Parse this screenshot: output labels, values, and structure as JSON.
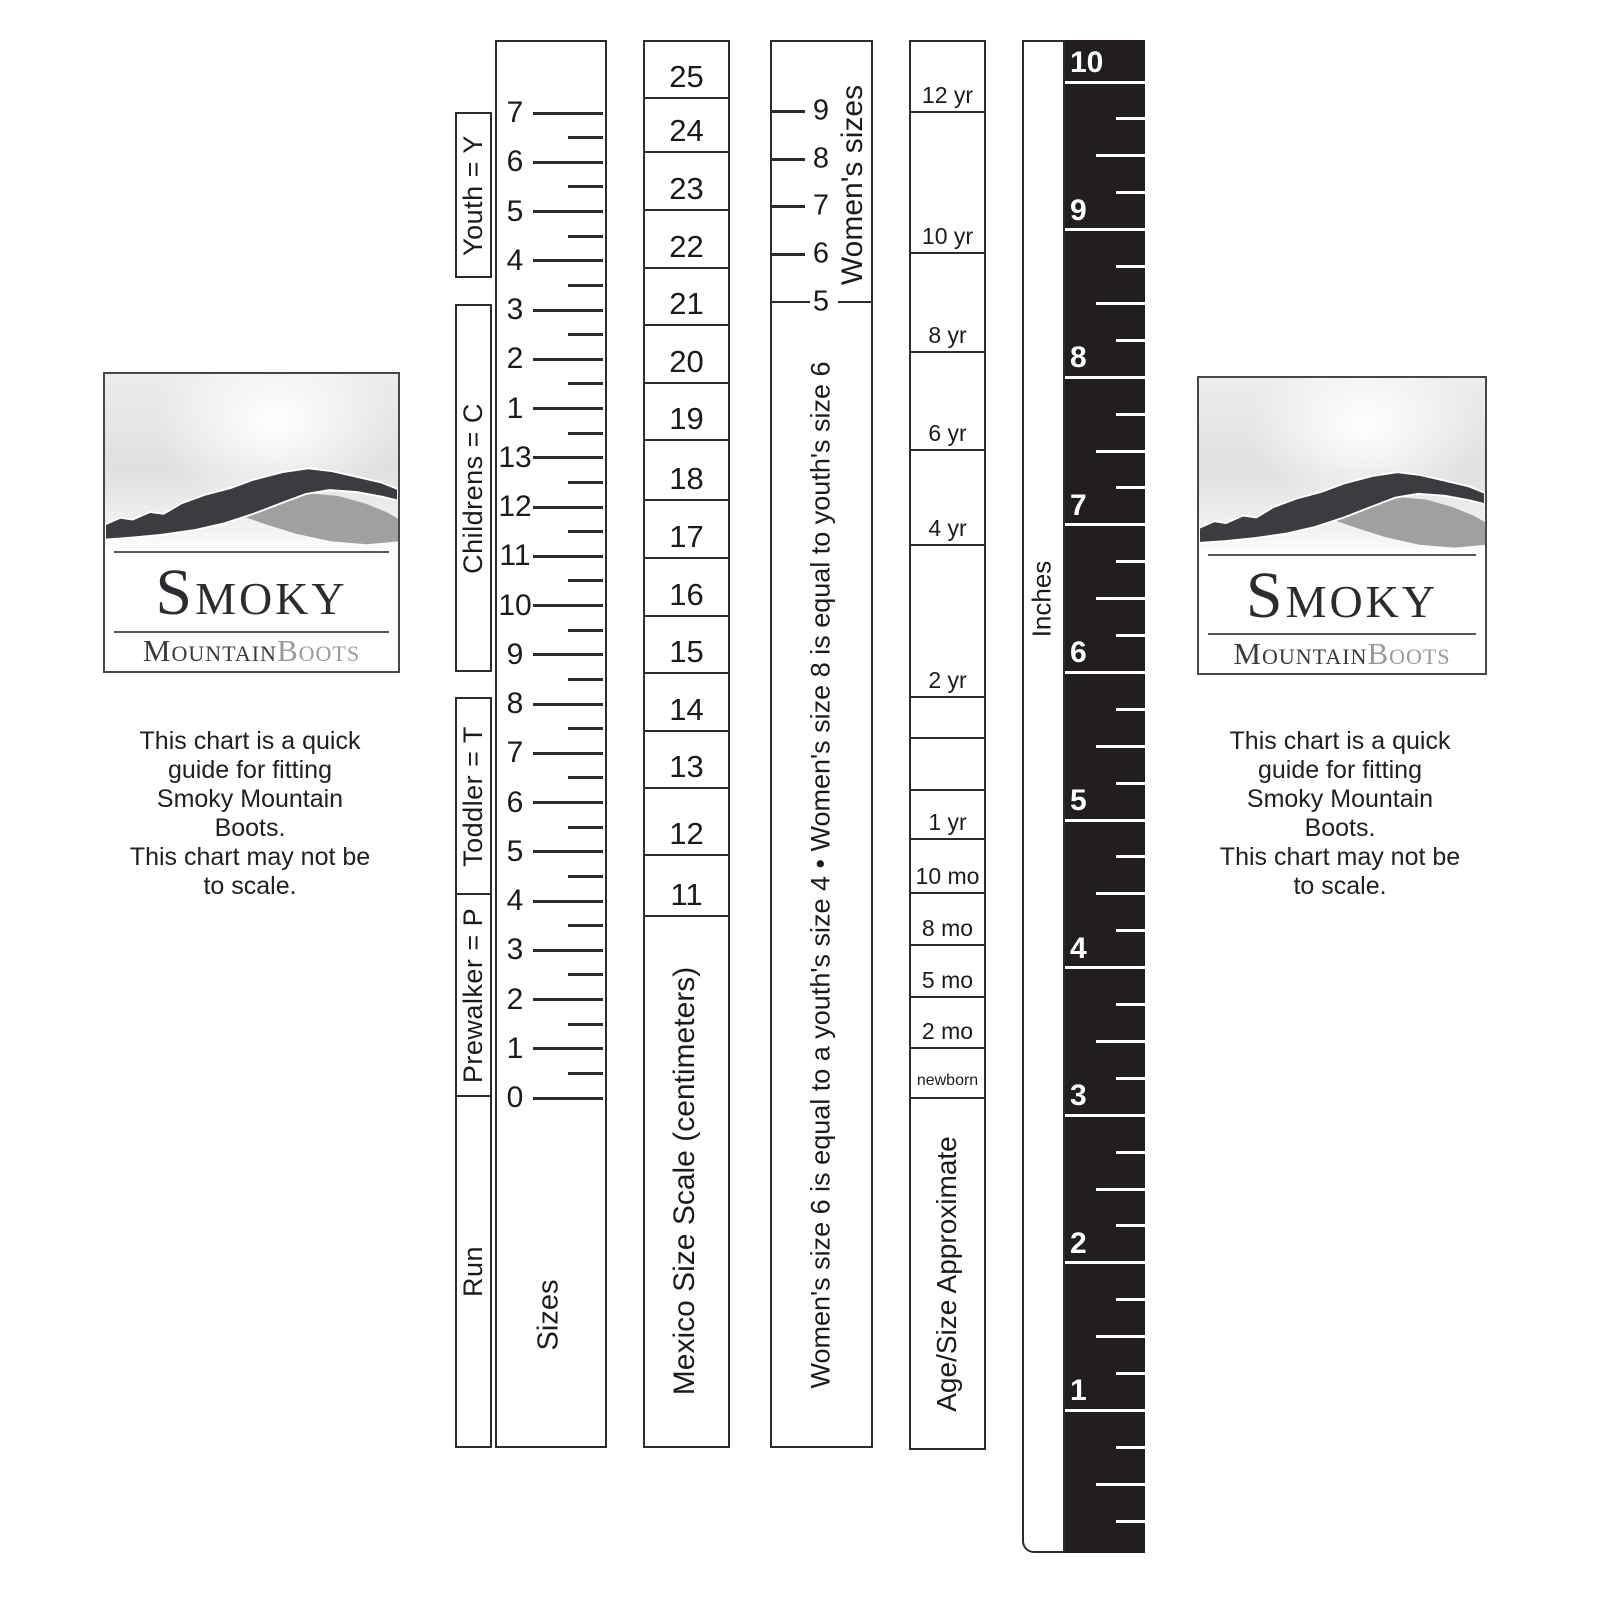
{
  "colors": {
    "line": "#2b2b2b",
    "ink": "#1b1b1b",
    "ruler_black": "#221e1e",
    "logo_dark": "#3c3c40",
    "logo_gray": "#a0a0a3",
    "boots_text": "#9a9a9a"
  },
  "logo": {
    "title": "Smoky",
    "word_dark": "Mountain",
    "word_light": "Boots"
  },
  "note": {
    "lines": [
      "This chart is a quick",
      "guide for fitting",
      "Smoky Mountain",
      "Boots.",
      "This chart may not be",
      "to scale."
    ]
  },
  "bracket_column": {
    "boxes": [
      {
        "label": "Youth = Y",
        "top": 112,
        "bottom": 278
      },
      {
        "label": "Childrens = C",
        "top": 304,
        "bottom": 672
      },
      {
        "label": "Toddler = T",
        "top": 697,
        "bottom": 895
      },
      {
        "label": "Prewalker = P",
        "top": 893,
        "bottom": 1097
      },
      {
        "label": "Run",
        "top": 1095,
        "bottom": 1448
      }
    ]
  },
  "sizes_column": {
    "label": "Sizes",
    "sizes": [
      "7",
      "6",
      "5",
      "4",
      "3",
      "2",
      "1",
      "13",
      "12",
      "11",
      "10",
      "9",
      "8",
      "7",
      "6",
      "5",
      "4",
      "3",
      "2",
      "1",
      "0"
    ],
    "first_tick_y": 113,
    "tick_step": 49.25
  },
  "mexico_column": {
    "label": "Mexico Size Scale (centimeters)",
    "cells": [
      {
        "value": "25",
        "bottom": 98
      },
      {
        "value": "24",
        "bottom": 152
      },
      {
        "value": "23",
        "bottom": 210
      },
      {
        "value": "22",
        "bottom": 268
      },
      {
        "value": "21",
        "bottom": 325
      },
      {
        "value": "20",
        "bottom": 383
      },
      {
        "value": "19",
        "bottom": 440
      },
      {
        "value": "18",
        "bottom": 500
      },
      {
        "value": "17",
        "bottom": 558
      },
      {
        "value": "16",
        "bottom": 616
      },
      {
        "value": "15",
        "bottom": 673
      },
      {
        "value": "14",
        "bottom": 731
      },
      {
        "value": "13",
        "bottom": 788
      },
      {
        "value": "12",
        "bottom": 855
      },
      {
        "value": "11",
        "bottom": 916
      }
    ]
  },
  "womens_column": {
    "heading": "Women's sizes",
    "ticks": [
      {
        "label": "9",
        "y": 111
      },
      {
        "label": "8",
        "y": 159
      },
      {
        "label": "7",
        "y": 206
      },
      {
        "label": "6",
        "y": 254
      }
    ],
    "divider": {
      "label": "5",
      "y": 302
    },
    "note": "Women's size 6 is equal to a youth's size 4 • Women's size 8 is equal to youth's size 6"
  },
  "age_column": {
    "label": "Age/Size Approximate",
    "cells": [
      {
        "label": "12 yr",
        "bottom": 112
      },
      {
        "label": "10 yr",
        "bottom": 253
      },
      {
        "label": "8 yr",
        "bottom": 352
      },
      {
        "label": "6 yr",
        "bottom": 450
      },
      {
        "label": "4 yr",
        "bottom": 545
      },
      {
        "label": "2 yr",
        "bottom": 697
      },
      {
        "label": "",
        "bottom": 738
      },
      {
        "label": "",
        "bottom": 790
      },
      {
        "label": "1 yr",
        "bottom": 839
      },
      {
        "label": "10 mo",
        "bottom": 893
      },
      {
        "label": "8 mo",
        "bottom": 945
      },
      {
        "label": "5 mo",
        "bottom": 997
      },
      {
        "label": "2 mo",
        "bottom": 1048
      },
      {
        "label": "newborn",
        "bottom": 1098,
        "small": true
      }
    ]
  },
  "inches_ruler": {
    "label": "Inches",
    "numbers": [
      "10",
      "9",
      "8",
      "7",
      "6",
      "5",
      "4",
      "3",
      "2",
      "1"
    ],
    "first_line_y": 82,
    "line_step": 147.6,
    "bottom": 1553
  }
}
